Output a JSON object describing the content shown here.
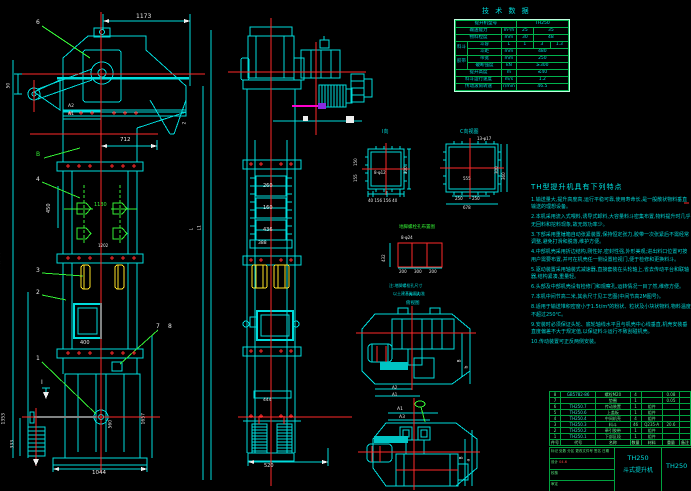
{
  "tech_table": {
    "title": "技 术 数 据",
    "rows": [
      {
        "label": "提升机型号",
        "value": "TH250"
      },
      {
        "label": "输送能力",
        "unit": "m³/h",
        "v1": "25",
        "v2": "35"
      },
      {
        "label": "物料粒度",
        "unit": "mm",
        "v1": "30",
        "v2": "48"
      },
      {
        "group": "料斗",
        "label": "斗容",
        "unit": "L",
        "v1": "1",
        "v2": "3",
        "v3": "1.3"
      },
      {
        "label": "斗距",
        "unit": "mm",
        "v1": "480"
      },
      {
        "group": "胶带",
        "label": "带宽",
        "unit": "mm",
        "v1": "250"
      },
      {
        "label": "破断强度",
        "unit": "kN",
        "v1": "≥300"
      },
      {
        "label": "提升高度",
        "unit": "m",
        "v1": "≤40"
      },
      {
        "label": "料斗运行速度",
        "unit": "m/s",
        "v1": "1.2"
      },
      {
        "label": "传动滚筒转速",
        "unit": "r/min",
        "v1": "46.5"
      }
    ]
  },
  "features": {
    "title": "TH型提升机具有下列特点",
    "items": [
      "1.输送量大,提升高度高,运行平稳可靠,使用寿命长,是一般散状物料垂直输送的理想设备。",
      "2.本机采用流入式喂料,诱导式卸料,大容量料斗密集布置,物料提升时几乎无回料和挖料现象,故无效功率少。",
      "3.下部采用重锤箱自动张紧装置,保持恒定张力,胶带一次张紧后不需经常调整,避免打滑和脱落,维护方便。",
      "4.中部机壳采用折边结构,刚性好,密封性强,外形美观;进出料口位置可按用户需要布置,并可在机壳任一侧设置检视门,便于检修和更换料斗。",
      "5.驱动装置采用轴装式减速器,直接套装在头轮轴上,省去传动平台和联轴器,结构紧凑,重量轻。",
      "6.头部及中部机壳设有检修门和观察孔,运转情况一目了然,维修方便。",
      "7.本机中间节高二米,其余尺寸见工艺图(中间节高2M图号)。",
      "8.适用于输送堆积密度小于1.5t/m³的粉状、粒状及小块状物料,物料温度不超过250℃。",
      "9.安装时必须保证头轮、底轮轴线水平且与机壳中心线垂直,机壳安装垂直度偏差不大于规定值,以保证料斗运行不致刮碰机壳。",
      "10.传动装置可正反两侧安装。"
    ]
  },
  "bom": {
    "headers": {
      "no": "件号",
      "code": "代号",
      "name": "名称",
      "qty": "数量",
      "material": "材料",
      "weight": "重量",
      "remark": "备注"
    },
    "rows": [
      {
        "no": "8",
        "code": "GB5782-86",
        "name": "螺栓M20",
        "qty": "4",
        "material": "",
        "weight": "0.08"
      },
      {
        "no": "7",
        "code": "",
        "name": "垫圈",
        "qty": "1",
        "material": "",
        "weight": "0.05"
      },
      {
        "no": "6",
        "code": "TH250.7",
        "name": "传动装置",
        "qty": "1",
        "material": "组件",
        "weight": ""
      },
      {
        "no": "5",
        "code": "TH250.6",
        "name": "上盖板",
        "qty": "1",
        "material": "组件",
        "weight": ""
      },
      {
        "no": "4",
        "code": "TH250.4",
        "name": "中间机壳",
        "qty": "4",
        "material": "组件",
        "weight": ""
      },
      {
        "no": "3",
        "code": "TH250.3",
        "name": "料斗",
        "qty": "46",
        "material": "Q235-A",
        "weight": "20.6"
      },
      {
        "no": "2",
        "code": "TH250.2",
        "name": "牵引胶带",
        "qty": "1",
        "material": "组件",
        "weight": ""
      },
      {
        "no": "1",
        "code": "TH250.1",
        "name": "下部区段",
        "qty": "1",
        "material": "组件",
        "weight": ""
      }
    ]
  },
  "title_block": {
    "row1": "标记 处数 分区 更改文件号 签名 日期",
    "design": "设计",
    "check": "校核",
    "approve": "审定",
    "red_note": "04.6",
    "model": "TH250",
    "product": "斗式提升机",
    "drawing_no": "TH250"
  },
  "labels": {
    "d1173": "1173",
    "b6": "6",
    "d50": "50",
    "a2": "A2",
    "a1": "A1",
    "d2": "2",
    "d712": "712",
    "lb": "B",
    "b4": "4",
    "d450": "450",
    "d1130": "1130",
    "d1202": "1202",
    "b3": "3",
    "b2": "2",
    "d400": "400",
    "b7": "7",
    "b8": "8",
    "b1": "1",
    "secI": "Ⅰ",
    "d1353": "1353",
    "d333": "333",
    "d560": "560",
    "d1657": "1657",
    "d1044": "1044",
    "dH": "H(提升高度)",
    "dL": "L",
    "dL1": "L1",
    "d260": "260",
    "d160": "160",
    "d436": "436",
    "d388": "388",
    "d444": "444",
    "d520": "520",
    "vi_title": "Ⅰ向",
    "vi_note": "8-φ12",
    "vi_bottom": "40 156 156 40",
    "vi_150": "150",
    "vi_155": "155",
    "vi_300": "300",
    "vc_title": "C向视图",
    "vc_note": "13-φ17",
    "vc_555": "555",
    "vc_250a": "250",
    "vc_250b": "250",
    "vc_678": "678",
    "vc_300": "300",
    "vc_360": "360",
    "an_title": "地脚螺栓孔布置图",
    "an_note": "8-φ24",
    "an_432": "432",
    "an_200a": "200",
    "an_300": "300",
    "an_200b": "200",
    "an_note1": "注:地脚螺栓孔尺寸",
    "an_note2": "以土建基础图为准",
    "p1_t1": "A—A",
    "p1_t2": "俯视图",
    "p1_a2": "A2",
    "p1_a1": "A1",
    "p1_B": "B",
    "p1_b": "b",
    "p2_a1": "A1",
    "p2_a3": "A3",
    "p2_B": "B",
    "p2_a": "a"
  }
}
